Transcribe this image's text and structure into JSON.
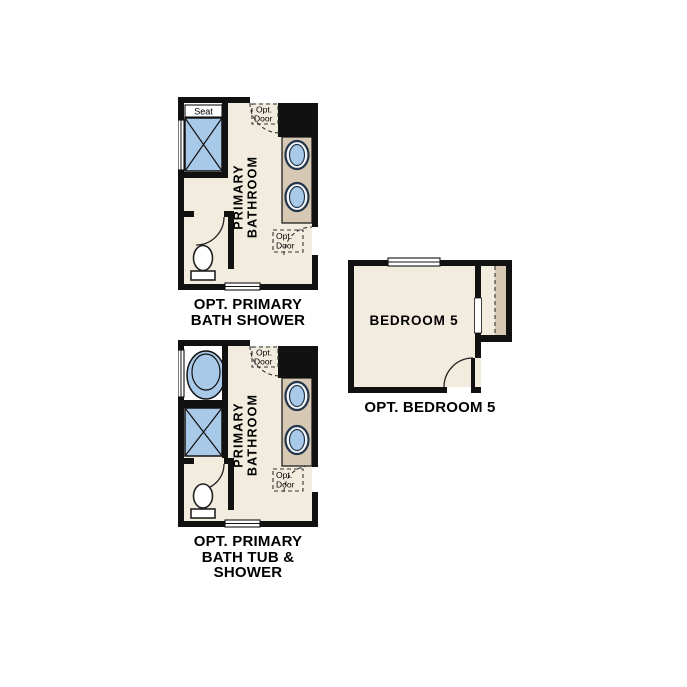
{
  "colors": {
    "wall": "#111111",
    "floor": "#f2ecdf",
    "counter": "#d6c8b3",
    "fixture": "#a9c9e9",
    "fixture_outline": "#22354a",
    "background": "#ffffff",
    "text": "#000000"
  },
  "plans": {
    "bath_shower": {
      "caption_line1": "OPT. PRIMARY",
      "caption_line2": "BATH SHOWER",
      "room_label_line1": "PRIMARY",
      "room_label_line2": "BATHROOM",
      "seat_label": "Seat",
      "opt_door_top_line1": "Opt.",
      "opt_door_top_line2": "Door",
      "opt_door_side_line1": "Opt.",
      "opt_door_side_line2": "Door"
    },
    "bath_tub_shower": {
      "caption_line1": "OPT. PRIMARY",
      "caption_line2": "BATH TUB &",
      "caption_line3": "SHOWER",
      "room_label_line1": "PRIMARY",
      "room_label_line2": "BATHROOM",
      "opt_door_top_line1": "Opt.",
      "opt_door_top_line2": "Door",
      "opt_door_side_line1": "Opt.",
      "opt_door_side_line2": "Door"
    },
    "bedroom5": {
      "caption": "OPT. BEDROOM 5",
      "room_label": "BEDROOM 5"
    }
  }
}
